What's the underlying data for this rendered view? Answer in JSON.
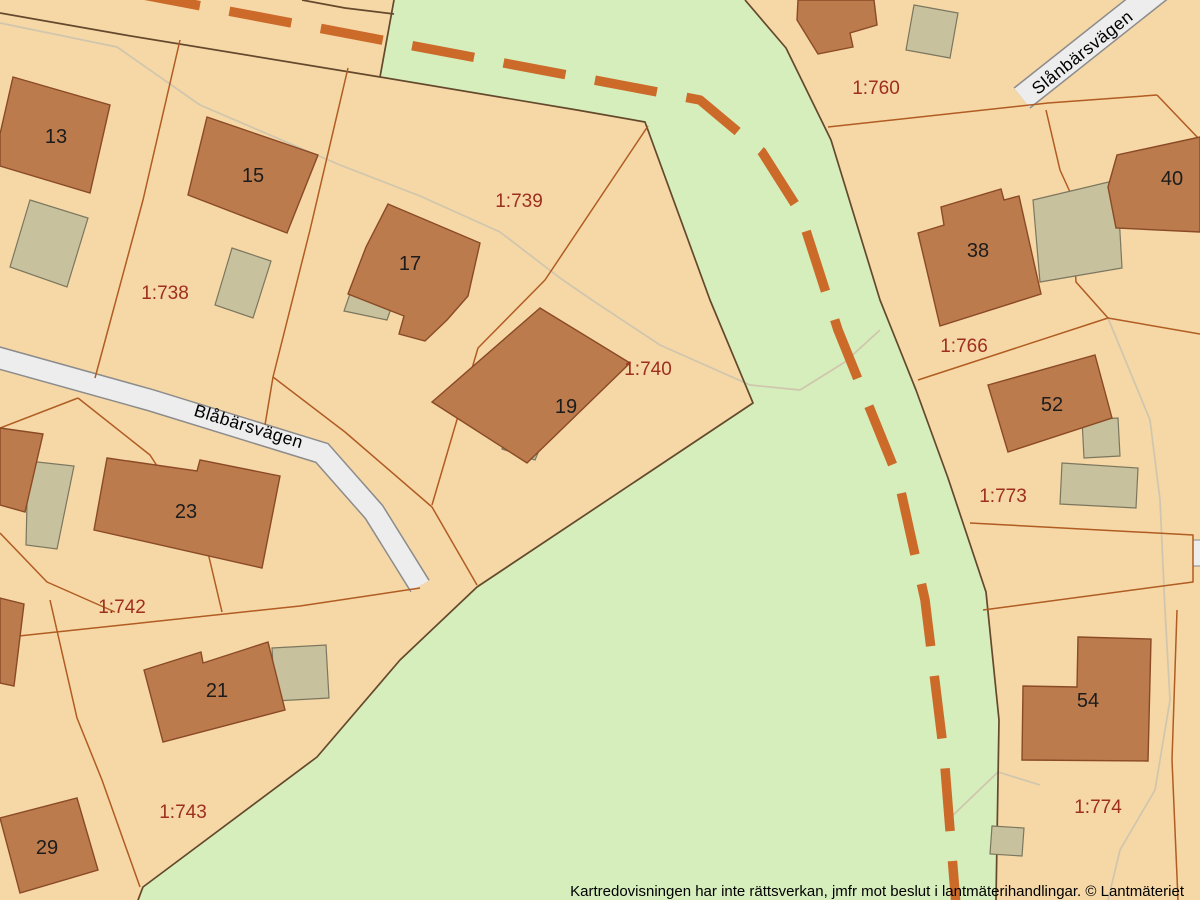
{
  "map": {
    "title": "Lantmäteriet cadastral map extract",
    "streets": [
      {
        "name": "Blåbärsvägen"
      },
      {
        "name": "Slånbärsvägen"
      }
    ],
    "parcels": [
      {
        "label": "1:738"
      },
      {
        "label": "1:739"
      },
      {
        "label": "1:740"
      },
      {
        "label": "1:742"
      },
      {
        "label": "1:743"
      },
      {
        "label": "1:760"
      },
      {
        "label": "1:766"
      },
      {
        "label": "1:773"
      },
      {
        "label": "1:774"
      }
    ],
    "buildings": [
      {
        "number": "13"
      },
      {
        "number": "15"
      },
      {
        "number": "17"
      },
      {
        "number": "19"
      },
      {
        "number": "21"
      },
      {
        "number": "23"
      },
      {
        "number": "29"
      },
      {
        "number": "38"
      },
      {
        "number": "40"
      },
      {
        "number": "52"
      },
      {
        "number": "54"
      }
    ],
    "footer": {
      "disclaimer": "Kartredovisningen har inte rättsverkan, jmfr mot beslut i lantmäterihandlingar. © Lantmäteriet"
    },
    "colors": {
      "parcel": "#f6d7a6",
      "green": "#d6edbc",
      "building": "#bb7b4c",
      "building_outline": "#8a4a26",
      "shed": "#c8c19e",
      "shed_outline": "#7b775f",
      "road_fill": "#ededed",
      "road_casing": "#8c8c8c",
      "boundary_dark": "#64492c",
      "boundary_orange": "#b05c22",
      "path_faint": "#cfc6ad",
      "dashed_line": "#cc6a29",
      "parcel_label": "#9e2f1e",
      "building_label": "#1c1c1c"
    }
  }
}
